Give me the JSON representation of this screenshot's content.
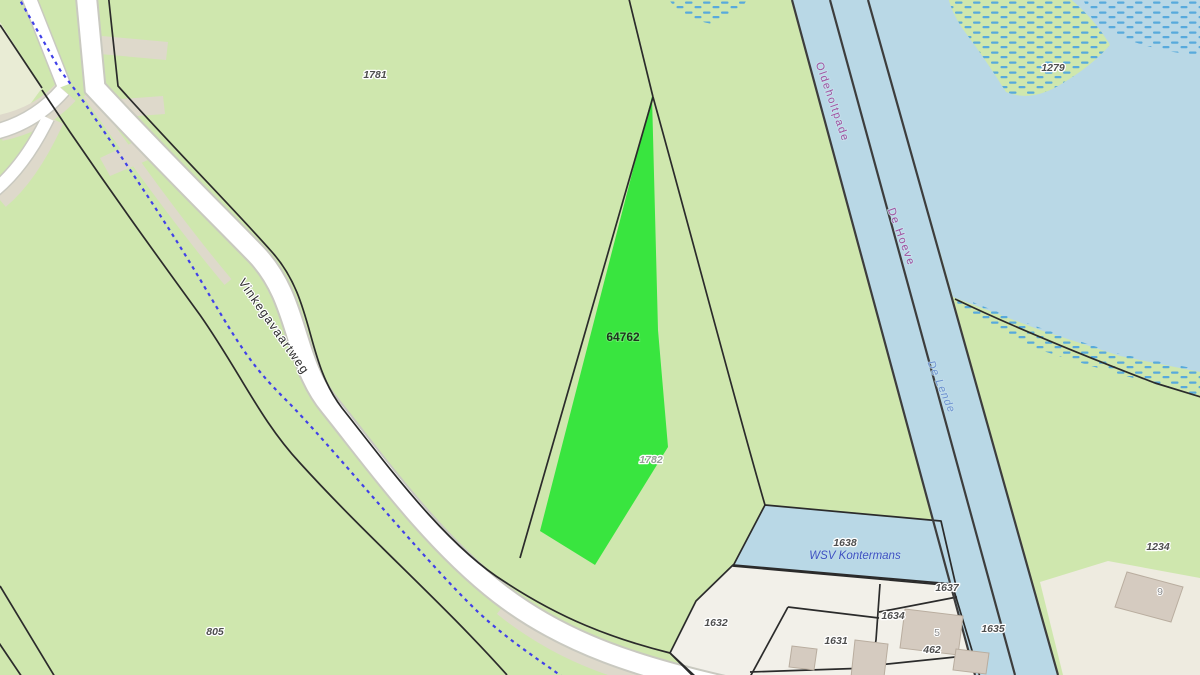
{
  "map": {
    "kind": "cadastral-parcel-map",
    "labels": {
      "p1781": "1781",
      "p64762": "64762",
      "p1782": "1782",
      "p805": "805",
      "p1279": "1279",
      "p1234": "1234",
      "p1638": "1638",
      "p1637": "1637",
      "p1632": "1632",
      "p1634": "1634",
      "p1631": "1631",
      "p1635": "1635",
      "p5": "5",
      "p462": "462",
      "p9": "9",
      "road": "Vinkegavaartweg",
      "boundary_left": "Oldeholtpade",
      "boundary_right": "De Hoeve",
      "water": "De Lende",
      "marina": "WSV Kontermans"
    }
  },
  "colors": {
    "field": "#cfe7ae",
    "highlight": "#39e53f",
    "water": "#b9d8e6",
    "marsh_dash": "#58aadc",
    "road_fill": "#ffffff",
    "road_casing": "#c9c9c0",
    "verge": "#ded9cb",
    "parcel_beige": "#e9ecd5",
    "yard_white": "#f2f0e9",
    "yard_beige": "#eeebe0",
    "building": "#d5cbc0",
    "building_border": "#b9ad9f",
    "cadastral_line": "#2b2b2b",
    "canal_line": "#3d3d3d",
    "path_blue": "#4040e8",
    "label_dark": "#4e4e4e",
    "label_light": "#98a098",
    "label_gray": "#8a8a8a",
    "label_boundary": "#a0529f",
    "label_water": "#6e93cf",
    "label_marina": "#3f51c1",
    "highlight_label": "#1f3320"
  }
}
